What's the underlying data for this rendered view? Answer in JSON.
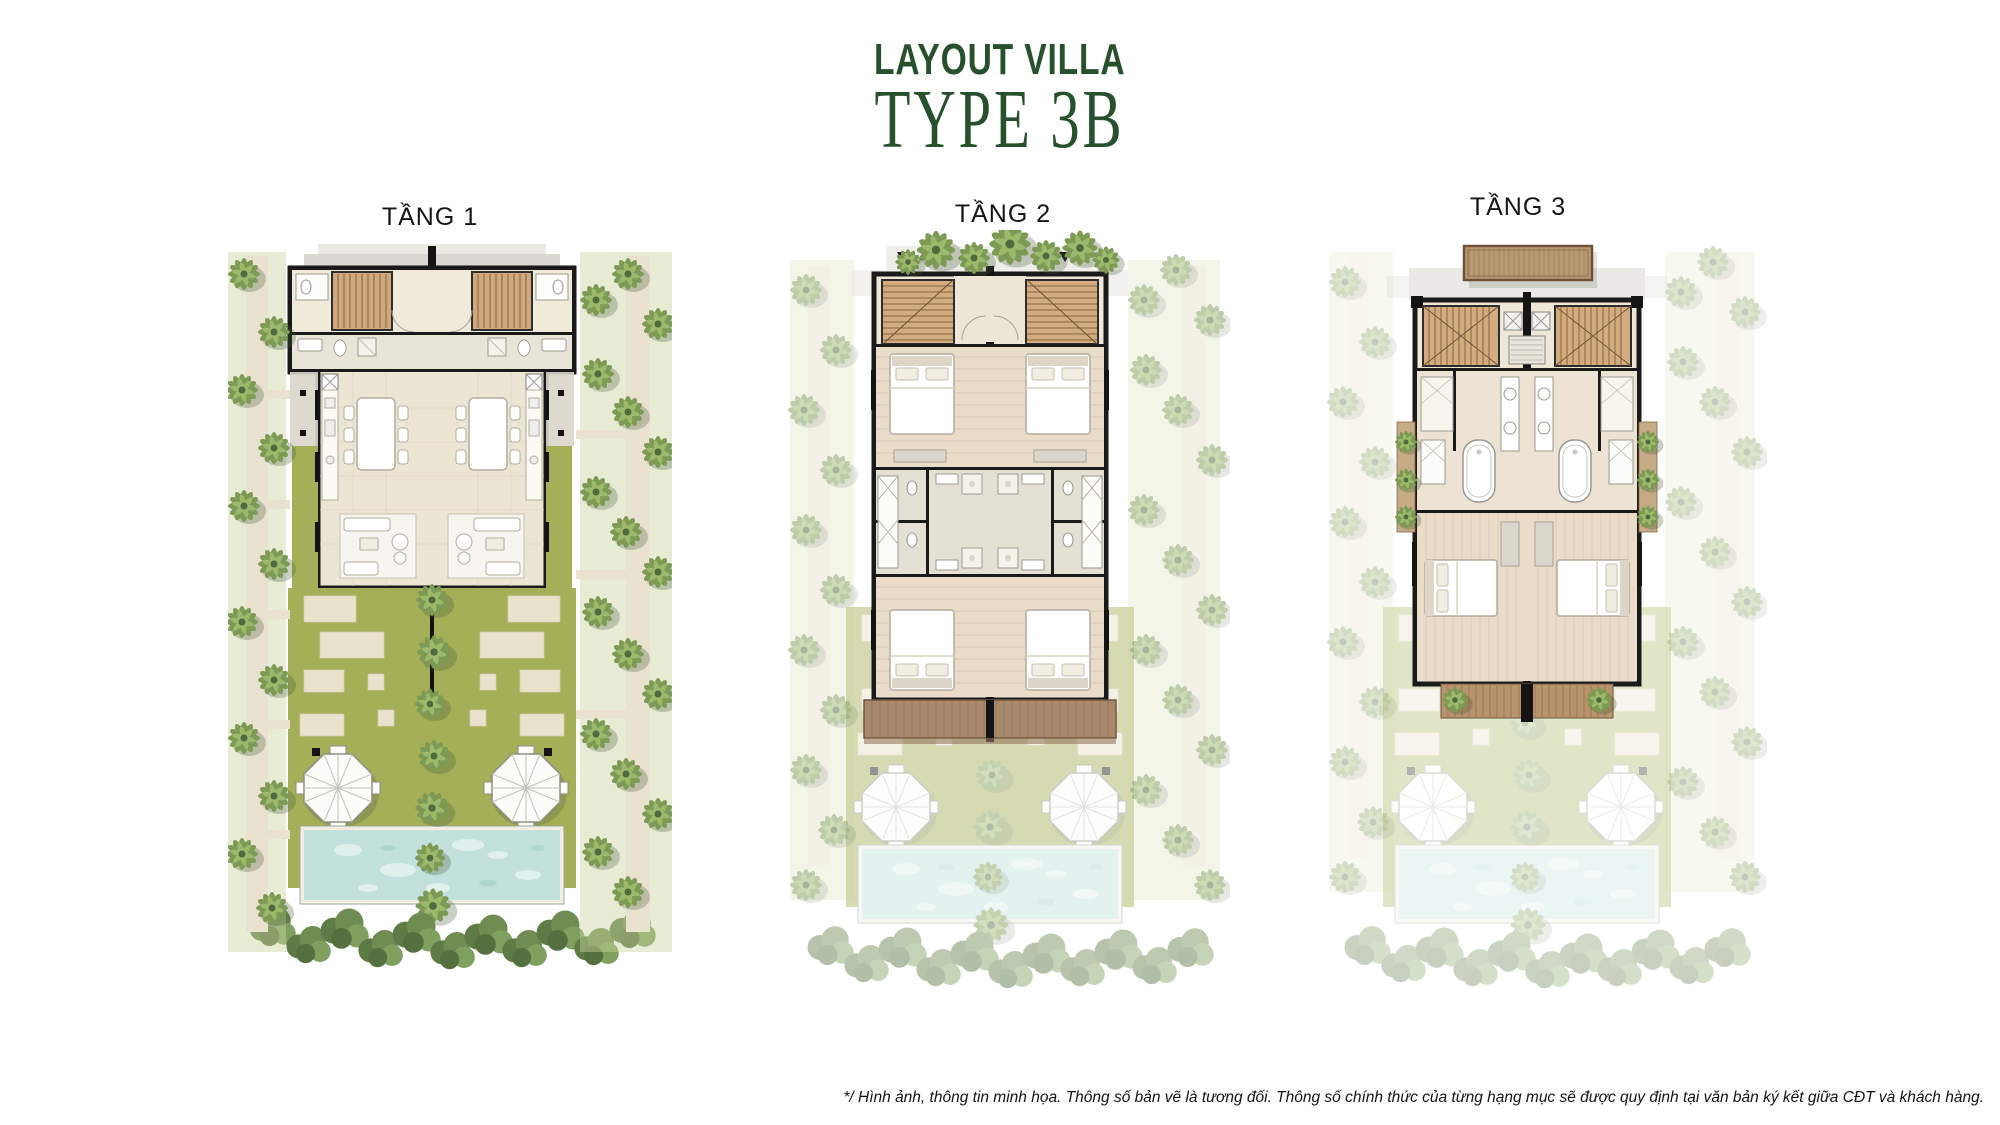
{
  "header": {
    "title": "LAYOUT VILLA",
    "subtitle": "TYPE 3B",
    "accent_color": "#26512c"
  },
  "floors": [
    {
      "id": "tang-1",
      "label": "TẦNG 1"
    },
    {
      "id": "tang-2",
      "label": "TẦNG 2"
    },
    {
      "id": "tang-3",
      "label": "TẦNG 3"
    }
  ],
  "footer": {
    "disclaimer": "*/ Hình ảnh, thông tin minh họa. Thông số bản vẽ là tương đối. Thông số chính thức của từng hạng mục sẽ được quy định tại văn bản ký kết giữa CĐT và khách hàng."
  },
  "palette": {
    "accent_green": "#26512c",
    "lawn_grass": "#a4af58",
    "pool_water": "#c2e1dc",
    "paving_stone": "#e9e2cc",
    "wood_stair": "#cfa97d",
    "wood_deck": "#a9896b",
    "wood_canopy": "#b89a77",
    "wall_black": "#1a1a1a",
    "floor_beige": "#ece5d4",
    "tree_green": "#7d9a55"
  }
}
